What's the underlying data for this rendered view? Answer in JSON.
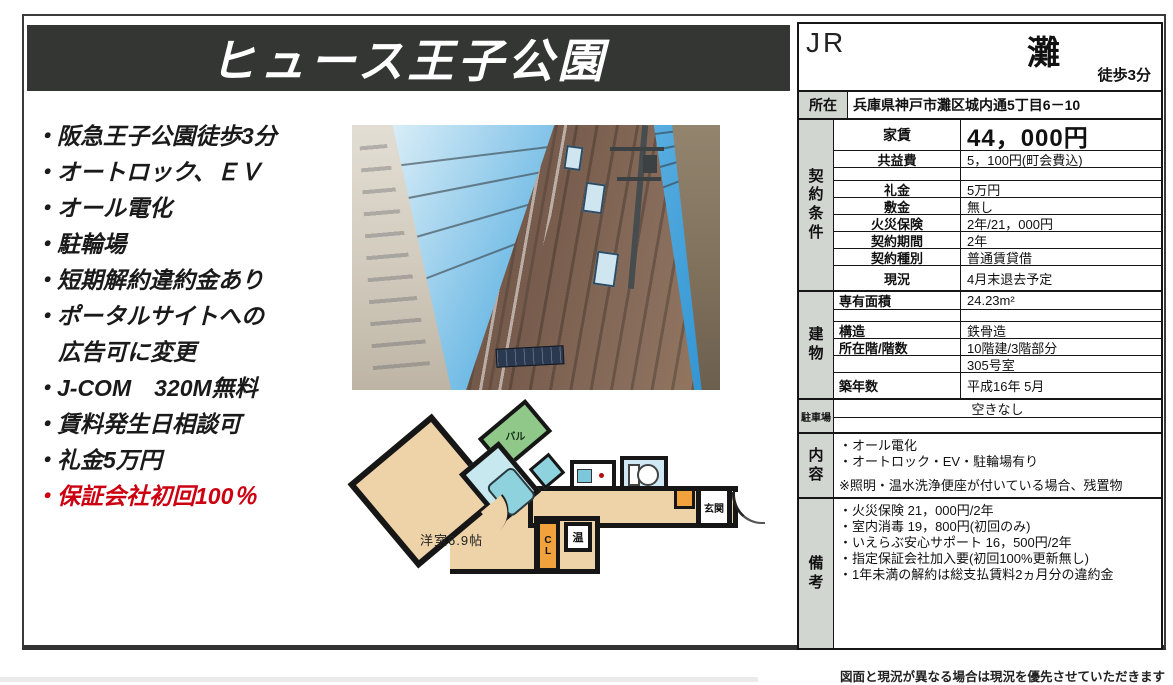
{
  "title": "ヒュース王子公園",
  "features": {
    "items": [
      "・阪急王子公園徒歩3分",
      "・オートロック、ＥＶ",
      "・オール電化",
      "・駐輪場",
      "・短期解約違約金あり",
      "・ポータルサイトへの",
      "広告可に変更",
      "・J-COM　320M無料",
      "・賃料発生日相談可",
      "・礼金5万円",
      "・保証会社初回100％"
    ]
  },
  "floorplan": {
    "balcony": "バル",
    "room": "洋室6.9帖",
    "closet": "CL",
    "water_heater": "温",
    "entrance": "玄関"
  },
  "table": {
    "rail_line": "JR",
    "station": "灘",
    "walk_time": "徒歩3分",
    "location": {
      "label": "所在",
      "value": "兵庫県神戸市灘区城内通5丁目6－10"
    },
    "contract": {
      "section_label": "契約条件",
      "rows": [
        {
          "label": "家賃",
          "value": "44，000円"
        },
        {
          "label": "共益費",
          "value": "5，100円(町会費込)"
        },
        {
          "label": "",
          "value": ""
        },
        {
          "label": "礼金",
          "value": "5万円"
        },
        {
          "label": "敷金",
          "value": "無し"
        },
        {
          "label": "火災保険",
          "value": "2年/21，000円"
        },
        {
          "label": "契約期間",
          "value": "2年"
        },
        {
          "label": "契約種別",
          "value": "普通賃貸借"
        },
        {
          "label": "現況",
          "value": "4月末退去予定"
        }
      ]
    },
    "building": {
      "section_label": "建物",
      "rows": [
        {
          "label": "専有面積",
          "value": "24.23m²"
        },
        {
          "label": "",
          "value": ""
        },
        {
          "label": "構造",
          "value": "鉄骨造"
        },
        {
          "label": "所在階/階数",
          "value": "10階建/3階部分"
        },
        {
          "label": "",
          "value": "305号室"
        },
        {
          "label": "築年数",
          "value": "平成16年 5月"
        }
      ]
    },
    "parking": {
      "section_label": "駐車場",
      "value": "空きなし"
    },
    "contents": {
      "section_label": "内容",
      "lines": [
        "・オール電化",
        "・オートロック・EV・駐輪場有り",
        "",
        "※照明・温水洗浄便座が付いている場合、残置物"
      ]
    },
    "remarks": {
      "section_label": "備考",
      "lines": [
        "・火災保険 21，000円/2年",
        "・室内消毒 19，800円(初回のみ)",
        "・いえらぶ安心サポート 16，500円/2年",
        "・指定保証会社加入要(初回100%更新無し)",
        "・1年未満の解約は総支払賃料2ヵ月分の違約金"
      ]
    }
  },
  "footer": {
    "disclaimer": "図面と現況が異なる場合は現況を優先させていただきます"
  },
  "colors": {
    "banner_bg": "#343634",
    "highlight_red": "#cc0011",
    "table_label_gray": "#d2d6d0",
    "floorplan_floor": "#efd3a8",
    "floorplan_balcony": "#8fc888",
    "floorplan_bath": "#c6e8ee",
    "floorplan_closet": "#f2a23c",
    "photo_sky_blue": "#2f93d2",
    "photo_building_brown": "#74594a"
  }
}
